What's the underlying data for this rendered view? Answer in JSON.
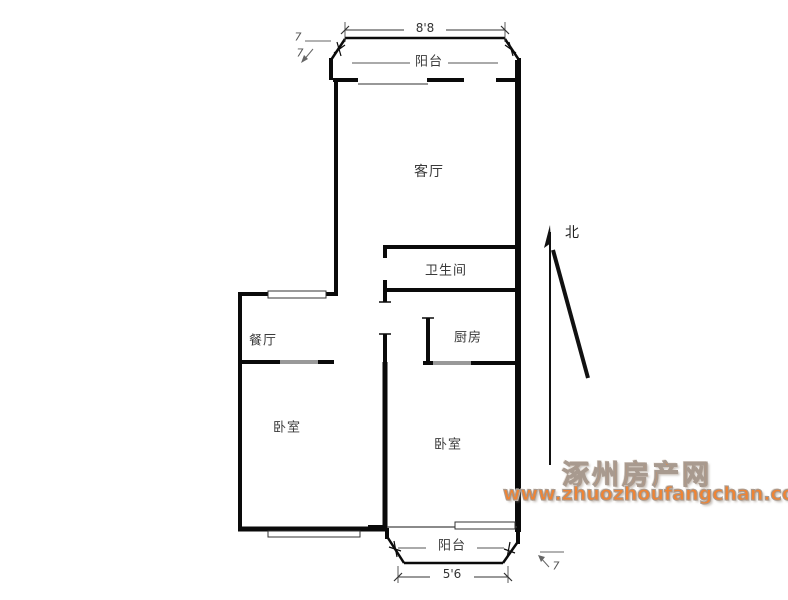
{
  "plan": {
    "rooms": [
      {
        "id": "balcony-top",
        "label": "阳台"
      },
      {
        "id": "living-room",
        "label": "客厅"
      },
      {
        "id": "bathroom",
        "label": "卫生间"
      },
      {
        "id": "dining-room",
        "label": "餐厅"
      },
      {
        "id": "kitchen",
        "label": "厨房"
      },
      {
        "id": "bedroom-left",
        "label": "卧室"
      },
      {
        "id": "bedroom-right",
        "label": "卧室"
      },
      {
        "id": "balcony-bottom",
        "label": "阳台"
      }
    ],
    "dimensions": {
      "top_width": "8'8",
      "bottom_width": "5'6",
      "corner_mark_top_a": "7",
      "corner_mark_top_b": "7",
      "corner_mark_bottom": "7"
    },
    "compass": {
      "north_label": "北"
    }
  },
  "watermark": {
    "site_name": "涿州房产网",
    "site_url": "www.zhuozhoufangchan.com",
    "color": "#ef8434"
  },
  "colors": {
    "wall": "#0a0a0a",
    "door_opening": "#999999",
    "window_line": "#777777",
    "background": "#ffffff"
  }
}
